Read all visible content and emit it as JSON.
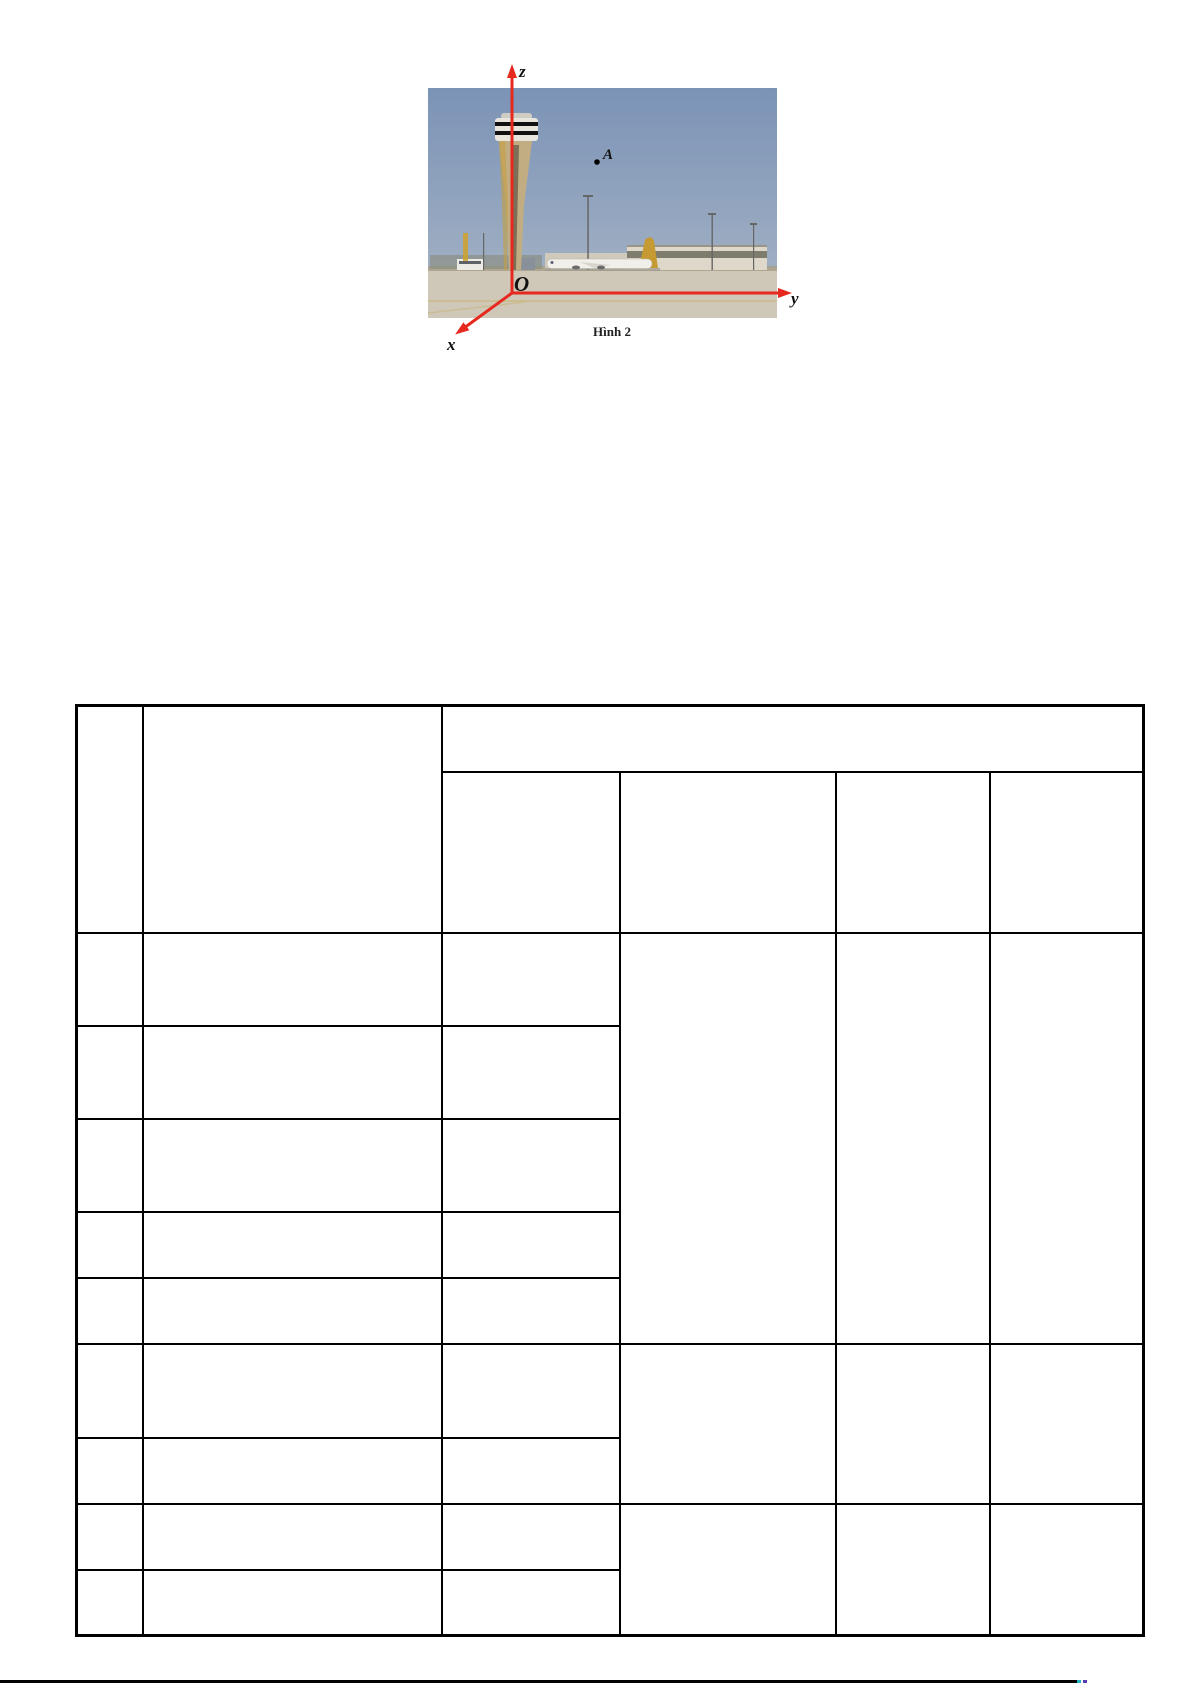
{
  "figure": {
    "caption": "Hình 2",
    "labels": {
      "z_axis": "z",
      "y_axis": "y",
      "x_axis": "x",
      "point": "A",
      "origin": "O"
    },
    "colors": {
      "axis_red": "#e6281e",
      "sky_top": "#7b93b6",
      "sky_bottom": "#aebbc9",
      "ground": "#cfc8b8",
      "tower_shaft": "#c2ad83",
      "tail_gold": "#c59a33"
    }
  },
  "table": {
    "header": {
      "col1": "",
      "col2": "",
      "group_header": "",
      "subheaders": [
        "",
        "",
        "",
        ""
      ]
    },
    "body": {
      "rows_col1": [
        "",
        "",
        "",
        "",
        "",
        "",
        "",
        "",
        ""
      ],
      "rows_col2": [
        "",
        "",
        "",
        "",
        "",
        "",
        "",
        "",
        ""
      ],
      "rows_col3": [
        "",
        "",
        "",
        "",
        "",
        "",
        "",
        "",
        ""
      ],
      "merged_col4": [
        "",
        "",
        ""
      ],
      "merged_col5": [
        "",
        "",
        ""
      ],
      "merged_col6": [
        "",
        "",
        ""
      ]
    }
  },
  "footer": {
    "rule_color": "#000000",
    "artifact_colors": {
      "cyan": "#22b6c8",
      "purple": "#5340b2"
    }
  }
}
